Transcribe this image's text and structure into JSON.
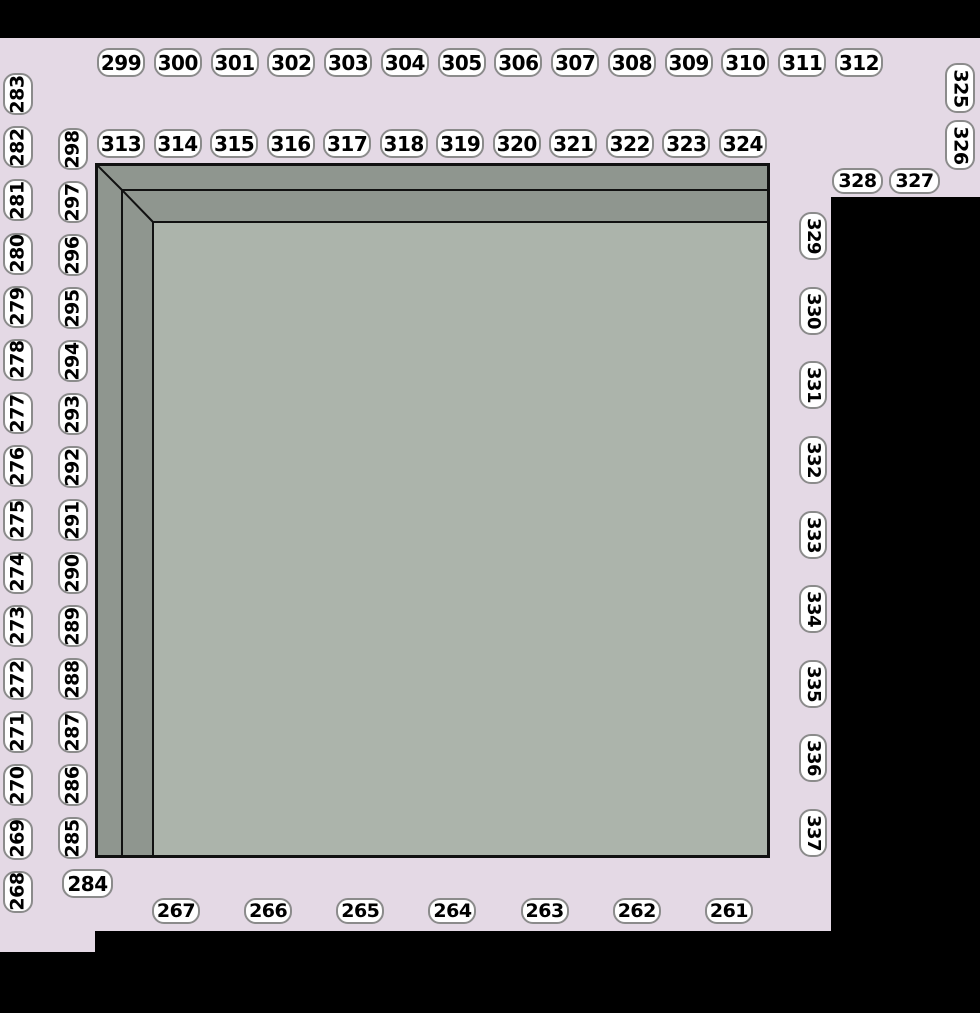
{
  "map_title": "venue-section-map",
  "colors": {
    "background": "#000000",
    "concourse": "#e4d9e5",
    "tier_band": "#8f968f",
    "floor": "#acb4ab",
    "outline": "#111111",
    "label_bg": "#ffffff",
    "label_border": "#8b8b8b",
    "label_text": "#000000"
  },
  "sections": {
    "top_row": [
      "299",
      "300",
      "301",
      "302",
      "303",
      "304",
      "305",
      "306",
      "307",
      "308",
      "309",
      "310",
      "311",
      "312"
    ],
    "second_row": [
      "313",
      "314",
      "315",
      "316",
      "317",
      "318",
      "319",
      "320",
      "321",
      "322",
      "323",
      "324"
    ],
    "left_outer_column": [
      "283",
      "282",
      "281",
      "280",
      "279",
      "278",
      "277",
      "276",
      "275",
      "274",
      "273",
      "272",
      "271",
      "270",
      "269",
      "268"
    ],
    "left_inner_column": [
      "298",
      "297",
      "296",
      "295",
      "294",
      "293",
      "292",
      "291",
      "290",
      "289",
      "288",
      "287",
      "286",
      "285"
    ],
    "right_far_column": [
      "325",
      "326"
    ],
    "right_pair": [
      "328",
      "327"
    ],
    "right_column": [
      "329",
      "330",
      "331",
      "332",
      "333",
      "334",
      "335",
      "336",
      "337"
    ],
    "bottom_left_corner": [
      "284"
    ],
    "bottom_row": [
      "267",
      "266",
      "265",
      "264",
      "263",
      "262",
      "261"
    ]
  }
}
